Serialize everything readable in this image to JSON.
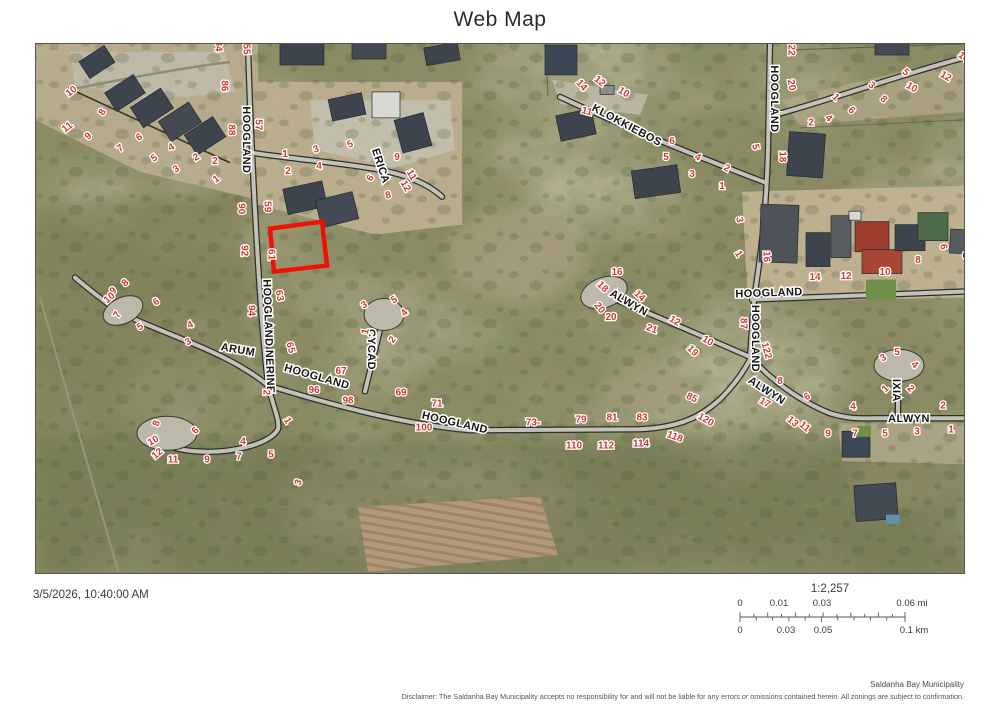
{
  "title": "Web Map",
  "timestamp": "3/5/2026, 10:40:00 AM",
  "scale": {
    "ratio": "1:2,257",
    "mi_labels": [
      "0",
      "0.01",
      "0.03",
      "0.06 mi"
    ],
    "km_labels": [
      "0",
      "0.03",
      "0.05",
      "0.1 km"
    ]
  },
  "attribution": "Saldanha Bay Municipality",
  "disclaimer": "Disclaimer: The Saldanha Bay Municipality accepts no responsibility for and will not be liable for any errors or omissions contained herein.  All zonings are subject to confirmation.",
  "map": {
    "highlight_color": "#ee1106",
    "parcel_label_color": "#cf3a33",
    "street_label_color": "#141414",
    "street_labels": [
      {
        "t": "HOOGLAND",
        "x": 247,
        "y": 140,
        "r": 90
      },
      {
        "t": "ERICA",
        "x": 381,
        "y": 166,
        "r": 72
      },
      {
        "t": "KLOKKIEBOS",
        "x": 627,
        "y": 125,
        "r": 28,
        "fs": 11.5
      },
      {
        "t": "HOOGLAND",
        "x": 775,
        "y": 99,
        "r": 90
      },
      {
        "t": "HOOGLAND",
        "x": 769,
        "y": 293,
        "r": -2
      },
      {
        "t": "HOOGLAND",
        "x": 756,
        "y": 339,
        "r": 90
      },
      {
        "t": "ALWYN",
        "x": 629,
        "y": 303,
        "r": 30
      },
      {
        "t": "ALWYN",
        "x": 767,
        "y": 391,
        "r": 33
      },
      {
        "t": "ALWYN",
        "x": 909,
        "y": 419,
        "r": 0
      },
      {
        "t": "ARUM",
        "x": 238,
        "y": 350,
        "r": 10
      },
      {
        "t": "HOOGLAND NERINE",
        "x": 269,
        "y": 337,
        "r": 88,
        "fs": 10
      },
      {
        "t": "HOOGLAND",
        "x": 317,
        "y": 377,
        "r": 16
      },
      {
        "t": "HOOGLAND",
        "x": 455,
        "y": 423,
        "r": 13
      },
      {
        "t": "CYCAD",
        "x": 372,
        "y": 350,
        "r": 90
      },
      {
        "t": "IXIA",
        "x": 897,
        "y": 391,
        "r": 90
      },
      {
        "t": "S",
        "x": 967,
        "y": 256,
        "r": 90
      }
    ],
    "parcel_labels": [
      {
        "t": "10",
        "x": 71,
        "y": 91,
        "r": -38
      },
      {
        "t": "11",
        "x": 67,
        "y": 127,
        "r": -38
      },
      {
        "t": "9",
        "x": 88,
        "y": 136,
        "r": -38
      },
      {
        "t": "8",
        "x": 102,
        "y": 112,
        "r": -60
      },
      {
        "t": "7",
        "x": 120,
        "y": 148,
        "r": -38
      },
      {
        "t": "6",
        "x": 139,
        "y": 137,
        "r": -30
      },
      {
        "t": "5",
        "x": 154,
        "y": 158,
        "r": -35
      },
      {
        "t": "4",
        "x": 171,
        "y": 147,
        "r": -30
      },
      {
        "t": "3",
        "x": 176,
        "y": 169,
        "r": -35
      },
      {
        "t": "2",
        "x": 196,
        "y": 157,
        "r": -30
      },
      {
        "t": "2",
        "x": 215,
        "y": 161,
        "r": 0
      },
      {
        "t": "1",
        "x": 216,
        "y": 179,
        "r": -35
      },
      {
        "t": "84",
        "x": 219,
        "y": 46,
        "r": 90
      },
      {
        "t": "55",
        "x": 247,
        "y": 49,
        "r": 90
      },
      {
        "t": "86",
        "x": 225,
        "y": 86,
        "r": 90
      },
      {
        "t": "88",
        "x": 232,
        "y": 130,
        "r": 90
      },
      {
        "t": "57",
        "x": 259,
        "y": 125,
        "r": 90
      },
      {
        "t": "90",
        "x": 242,
        "y": 209,
        "r": 90
      },
      {
        "t": "59",
        "x": 268,
        "y": 207,
        "r": 90
      },
      {
        "t": "92",
        "x": 245,
        "y": 251,
        "r": 90
      },
      {
        "t": "61",
        "x": 272,
        "y": 255,
        "r": 90
      },
      {
        "t": "94",
        "x": 252,
        "y": 311,
        "r": 90
      },
      {
        "t": "63",
        "x": 280,
        "y": 296,
        "r": 80
      },
      {
        "t": "65",
        "x": 291,
        "y": 348,
        "r": 75
      },
      {
        "t": "1",
        "x": 285,
        "y": 154,
        "r": 0
      },
      {
        "t": "2",
        "x": 288,
        "y": 171,
        "r": 0
      },
      {
        "t": "3",
        "x": 316,
        "y": 149,
        "r": -20
      },
      {
        "t": "4",
        "x": 319,
        "y": 166,
        "r": 0
      },
      {
        "t": "5",
        "x": 350,
        "y": 144,
        "r": -25
      },
      {
        "t": "6",
        "x": 370,
        "y": 178,
        "r": -60
      },
      {
        "t": "9",
        "x": 397,
        "y": 157,
        "r": 0
      },
      {
        "t": "8",
        "x": 388,
        "y": 195,
        "r": -15
      },
      {
        "t": "11",
        "x": 412,
        "y": 175,
        "r": 60
      },
      {
        "t": "12",
        "x": 406,
        "y": 186,
        "r": 60
      },
      {
        "t": "14",
        "x": 582,
        "y": 85,
        "r": 50
      },
      {
        "t": "12",
        "x": 600,
        "y": 81,
        "r": 40
      },
      {
        "t": "10",
        "x": 624,
        "y": 92,
        "r": 30
      },
      {
        "t": "11",
        "x": 587,
        "y": 111,
        "r": 15
      },
      {
        "t": "6",
        "x": 672,
        "y": 141,
        "r": 0
      },
      {
        "t": "5",
        "x": 666,
        "y": 157,
        "r": 0
      },
      {
        "t": "4",
        "x": 698,
        "y": 157,
        "r": 30
      },
      {
        "t": "3",
        "x": 692,
        "y": 174,
        "r": 0
      },
      {
        "t": "2",
        "x": 727,
        "y": 168,
        "r": 30
      },
      {
        "t": "1",
        "x": 722,
        "y": 186,
        "r": 0
      },
      {
        "t": "5",
        "x": 756,
        "y": 147,
        "r": 80
      },
      {
        "t": "22",
        "x": 792,
        "y": 50,
        "r": 90
      },
      {
        "t": "20",
        "x": 792,
        "y": 85,
        "r": 80
      },
      {
        "t": "18",
        "x": 783,
        "y": 157,
        "r": 90
      },
      {
        "t": "1",
        "x": 836,
        "y": 97,
        "r": 45
      },
      {
        "t": "2",
        "x": 811,
        "y": 122,
        "r": 0
      },
      {
        "t": "4",
        "x": 829,
        "y": 118,
        "r": 45
      },
      {
        "t": "6",
        "x": 852,
        "y": 110,
        "r": 45
      },
      {
        "t": "3",
        "x": 872,
        "y": 85,
        "r": 45
      },
      {
        "t": "8",
        "x": 884,
        "y": 99,
        "r": 45
      },
      {
        "t": "5",
        "x": 906,
        "y": 72,
        "r": 45
      },
      {
        "t": "10",
        "x": 912,
        "y": 87,
        "r": 30
      },
      {
        "t": "12",
        "x": 946,
        "y": 76,
        "r": 30
      },
      {
        "t": "14",
        "x": 964,
        "y": 57,
        "r": 40
      },
      {
        "t": "9",
        "x": 983,
        "y": 100,
        "r": 45
      },
      {
        "t": "3",
        "x": 740,
        "y": 220,
        "r": 80
      },
      {
        "t": "1",
        "x": 739,
        "y": 254,
        "r": 60
      },
      {
        "t": "16",
        "x": 767,
        "y": 257,
        "r": 90
      },
      {
        "t": "14",
        "x": 815,
        "y": 277,
        "r": 0
      },
      {
        "t": "12",
        "x": 846,
        "y": 276,
        "r": 0
      },
      {
        "t": "10",
        "x": 885,
        "y": 272,
        "r": 0
      },
      {
        "t": "8",
        "x": 918,
        "y": 260,
        "r": 0
      },
      {
        "t": "6",
        "x": 944,
        "y": 247,
        "r": 80
      },
      {
        "t": "8",
        "x": 125,
        "y": 283,
        "r": -40
      },
      {
        "t": "9",
        "x": 113,
        "y": 291,
        "r": -40
      },
      {
        "t": "10",
        "x": 109,
        "y": 298,
        "r": -40
      },
      {
        "t": "7",
        "x": 117,
        "y": 315,
        "r": -60
      },
      {
        "t": "6",
        "x": 156,
        "y": 302,
        "r": -35
      },
      {
        "t": "5",
        "x": 140,
        "y": 327,
        "r": -30
      },
      {
        "t": "4",
        "x": 190,
        "y": 325,
        "r": -25
      },
      {
        "t": "3",
        "x": 188,
        "y": 342,
        "r": -30
      },
      {
        "t": "2",
        "x": 267,
        "y": 393,
        "r": 90
      },
      {
        "t": "1",
        "x": 288,
        "y": 421,
        "r": 60
      },
      {
        "t": "4",
        "x": 243,
        "y": 442,
        "r": 0
      },
      {
        "t": "6",
        "x": 195,
        "y": 431,
        "r": -45
      },
      {
        "t": "8",
        "x": 156,
        "y": 424,
        "r": -70
      },
      {
        "t": "10",
        "x": 153,
        "y": 441,
        "r": -30
      },
      {
        "t": "12",
        "x": 157,
        "y": 454,
        "r": -40
      },
      {
        "t": "11",
        "x": 173,
        "y": 460,
        "r": 0
      },
      {
        "t": "9",
        "x": 207,
        "y": 460,
        "r": 0
      },
      {
        "t": "7",
        "x": 239,
        "y": 457,
        "r": 0
      },
      {
        "t": "5",
        "x": 271,
        "y": 455,
        "r": 0
      },
      {
        "t": "3",
        "x": 298,
        "y": 483,
        "r": -70
      },
      {
        "t": "3",
        "x": 364,
        "y": 305,
        "r": -30
      },
      {
        "t": "5",
        "x": 394,
        "y": 300,
        "r": -30
      },
      {
        "t": "4",
        "x": 404,
        "y": 313,
        "r": -45
      },
      {
        "t": "1",
        "x": 365,
        "y": 332,
        "r": -80
      },
      {
        "t": "2",
        "x": 392,
        "y": 340,
        "r": -55
      },
      {
        "t": "67",
        "x": 341,
        "y": 371,
        "r": 0
      },
      {
        "t": "96",
        "x": 314,
        "y": 390,
        "r": 0
      },
      {
        "t": "98",
        "x": 348,
        "y": 401,
        "r": 0
      },
      {
        "t": "69",
        "x": 401,
        "y": 393,
        "r": 0
      },
      {
        "t": "71",
        "x": 437,
        "y": 404,
        "r": 0
      },
      {
        "t": "100",
        "x": 424,
        "y": 428,
        "r": 0
      },
      {
        "t": "73-",
        "x": 533,
        "y": 423,
        "r": 0
      },
      {
        "t": "79",
        "x": 581,
        "y": 420,
        "r": 0
      },
      {
        "t": "81",
        "x": 612,
        "y": 418,
        "r": 0
      },
      {
        "t": "83",
        "x": 642,
        "y": 418,
        "r": 0
      },
      {
        "t": "85",
        "x": 692,
        "y": 398,
        "r": 25
      },
      {
        "t": "110",
        "x": 574,
        "y": 446,
        "r": 0
      },
      {
        "t": "112",
        "x": 606,
        "y": 446,
        "r": 0
      },
      {
        "t": "114",
        "x": 641,
        "y": 444,
        "r": 0
      },
      {
        "t": "118",
        "x": 675,
        "y": 437,
        "r": 20
      },
      {
        "t": "120",
        "x": 706,
        "y": 420,
        "r": 30
      },
      {
        "t": "16",
        "x": 617,
        "y": 272,
        "r": 0
      },
      {
        "t": "18",
        "x": 603,
        "y": 287,
        "r": 45
      },
      {
        "t": "14",
        "x": 640,
        "y": 296,
        "r": 45
      },
      {
        "t": "20",
        "x": 600,
        "y": 308,
        "r": 50
      },
      {
        "t": "20",
        "x": 611,
        "y": 317,
        "r": 0
      },
      {
        "t": "21",
        "x": 652,
        "y": 329,
        "r": 20
      },
      {
        "t": "12",
        "x": 675,
        "y": 321,
        "r": 30
      },
      {
        "t": "10",
        "x": 708,
        "y": 341,
        "r": 30
      },
      {
        "t": "19",
        "x": 693,
        "y": 351,
        "r": 45
      },
      {
        "t": "87",
        "x": 744,
        "y": 324,
        "r": 90
      },
      {
        "t": "122",
        "x": 767,
        "y": 351,
        "r": 75
      },
      {
        "t": "8",
        "x": 780,
        "y": 381,
        "r": 0
      },
      {
        "t": "17",
        "x": 765,
        "y": 403,
        "r": 30
      },
      {
        "t": "6",
        "x": 807,
        "y": 397,
        "r": -30
      },
      {
        "t": "13",
        "x": 793,
        "y": 422,
        "r": 40
      },
      {
        "t": "11",
        "x": 805,
        "y": 427,
        "r": 40
      },
      {
        "t": "9",
        "x": 828,
        "y": 434,
        "r": 0
      },
      {
        "t": "7",
        "x": 855,
        "y": 434,
        "r": 0
      },
      {
        "t": "5",
        "x": 885,
        "y": 434,
        "r": 0
      },
      {
        "t": "3",
        "x": 917,
        "y": 432,
        "r": 0
      },
      {
        "t": "1",
        "x": 951,
        "y": 430,
        "r": 0
      },
      {
        "t": "2",
        "x": 943,
        "y": 406,
        "r": 0
      },
      {
        "t": "4",
        "x": 853,
        "y": 407,
        "r": 0
      },
      {
        "t": "3",
        "x": 883,
        "y": 358,
        "r": -30
      },
      {
        "t": "5",
        "x": 897,
        "y": 352,
        "r": 0
      },
      {
        "t": "4",
        "x": 915,
        "y": 365,
        "r": 45
      },
      {
        "t": "1",
        "x": 885,
        "y": 389,
        "r": -45
      },
      {
        "t": "2",
        "x": 911,
        "y": 389,
        "r": 45
      }
    ]
  }
}
